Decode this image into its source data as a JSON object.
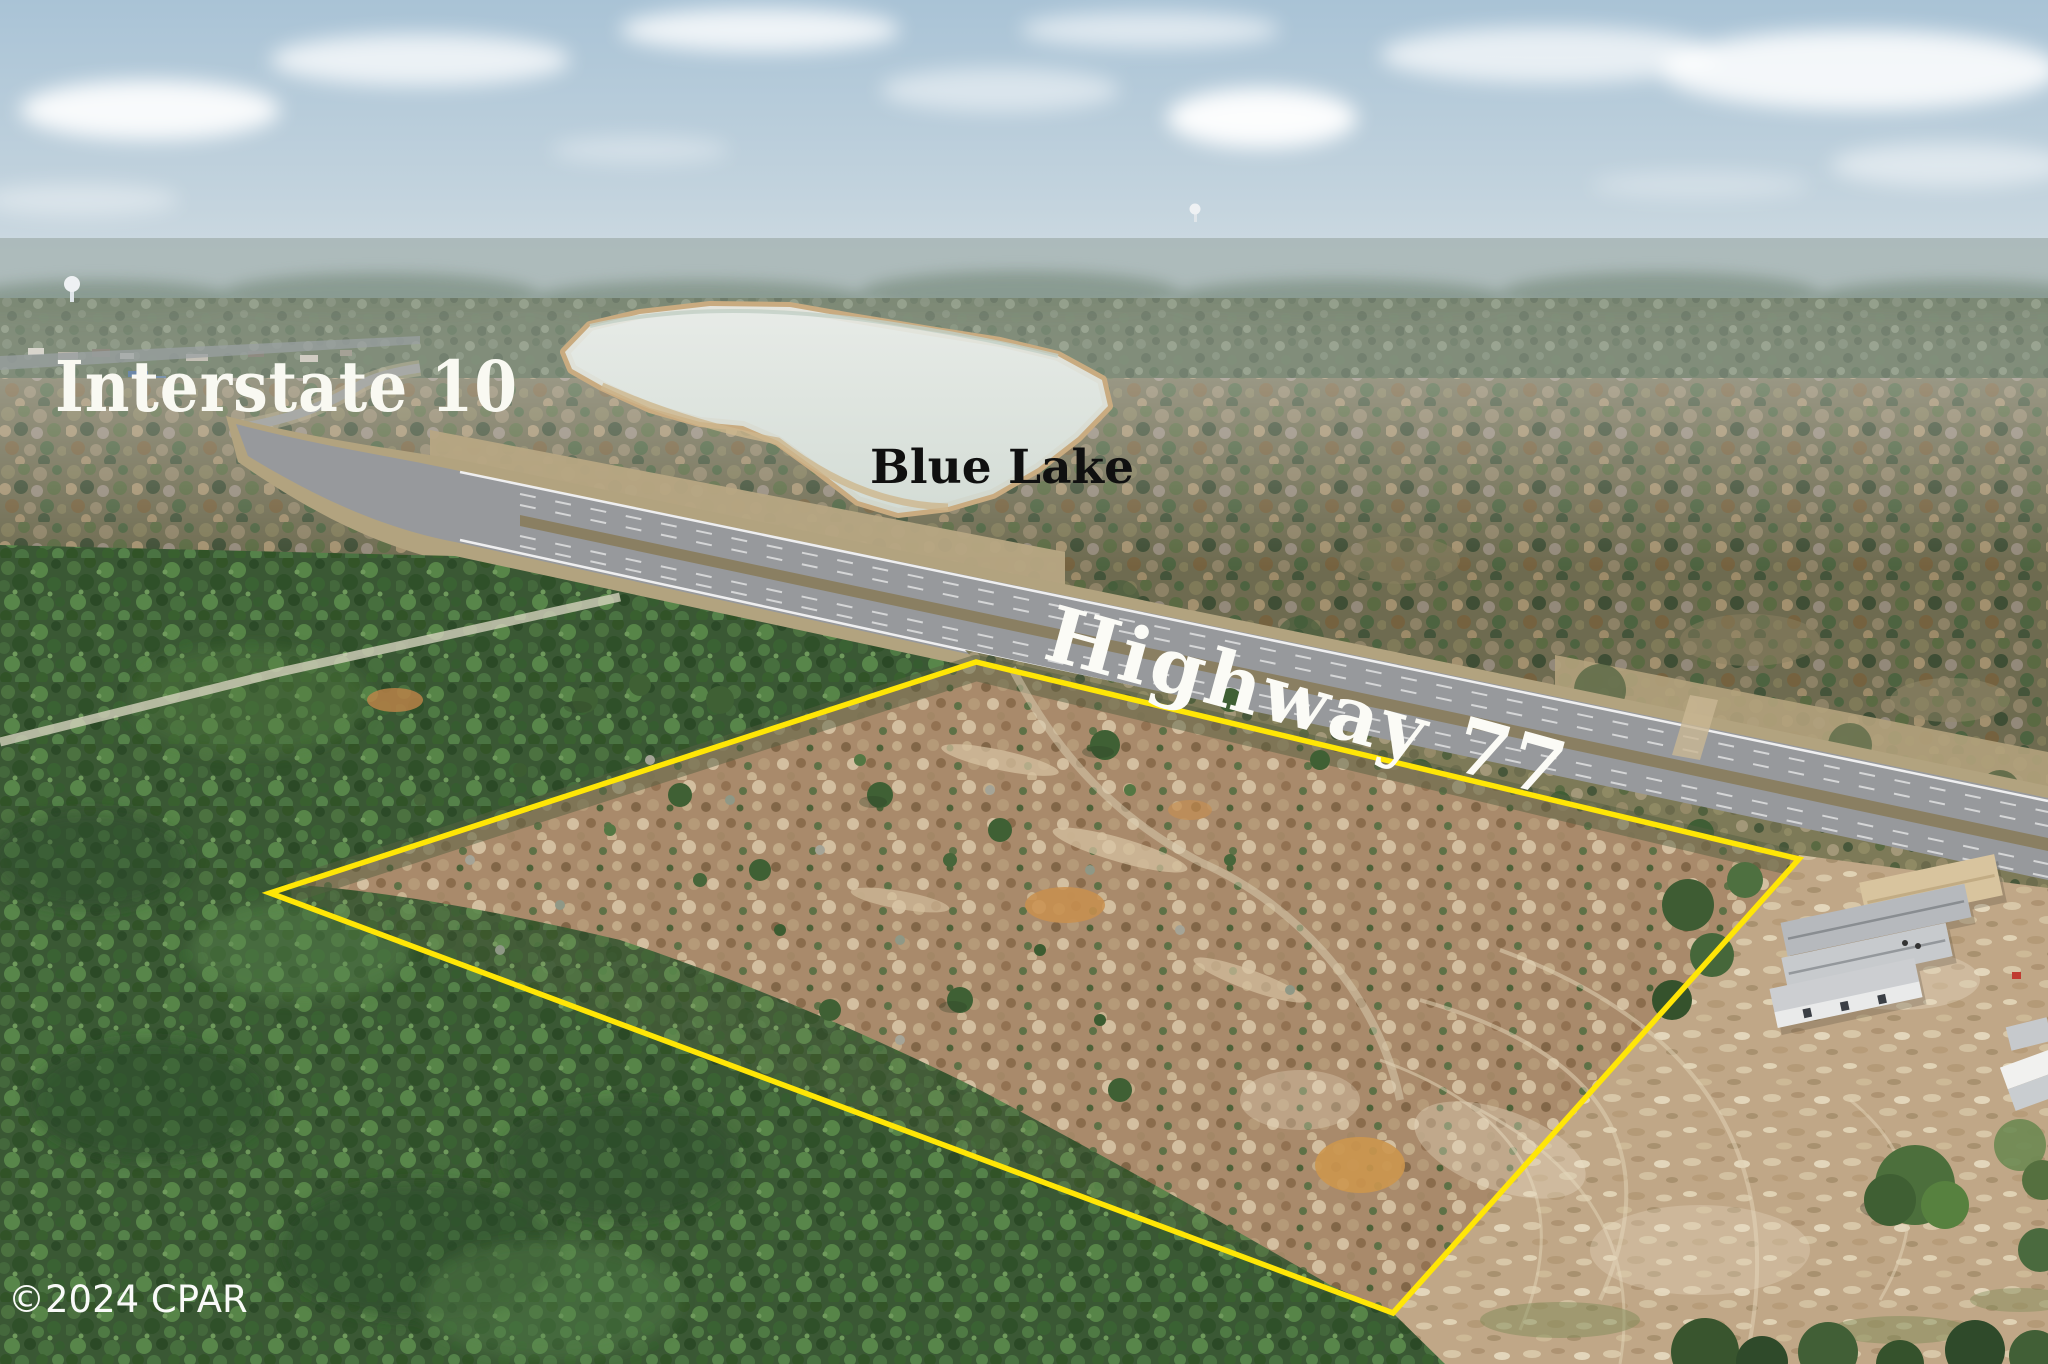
{
  "image": {
    "width": 2048,
    "height": 1364,
    "kind": "aerial-drone-photo"
  },
  "labels": {
    "interstate": "Interstate 10",
    "lake": "Blue Lake",
    "highway": "Highway 77"
  },
  "watermark": "©2024 CPAR",
  "boundary": {
    "color": "#ffe606",
    "stroke_width": 5.5,
    "points": "270,893 976,662 1799,859 1393,1313"
  },
  "scene": {
    "features": [
      "blue-lake-water",
      "interstate-10-corridor",
      "highway-77-divided-highway",
      "pine-plantation",
      "cleared-parcel-outlined-yellow",
      "mobile-home-sales-lot",
      "dirt-field-tire-tracks",
      "water-towers",
      "clouds"
    ]
  },
  "palette": {
    "sky_top": "#a9c3d6",
    "sky_low": "#d6e0e6",
    "cloud": "#ffffff",
    "haze": "#a7b5b4",
    "far_forest": "#7c8874",
    "mixed_forest": "#6e6b50",
    "pine_forest": "#3c5a36",
    "field_grass": "#b7a683",
    "lake": "#e2e7e2",
    "shore_sand": "#c9ab80",
    "asphalt": "#97999c",
    "median": "#8a7f62",
    "lane_line": "#ffffff",
    "property_ground": "#a98a6b",
    "orange_sand": "#c98f4e",
    "dirt_lot": "#c0a787",
    "dirt_track": "#e0d2b4",
    "home_roof_gray": "#c7cacd",
    "home_roof_tan": "#d8c49e"
  }
}
